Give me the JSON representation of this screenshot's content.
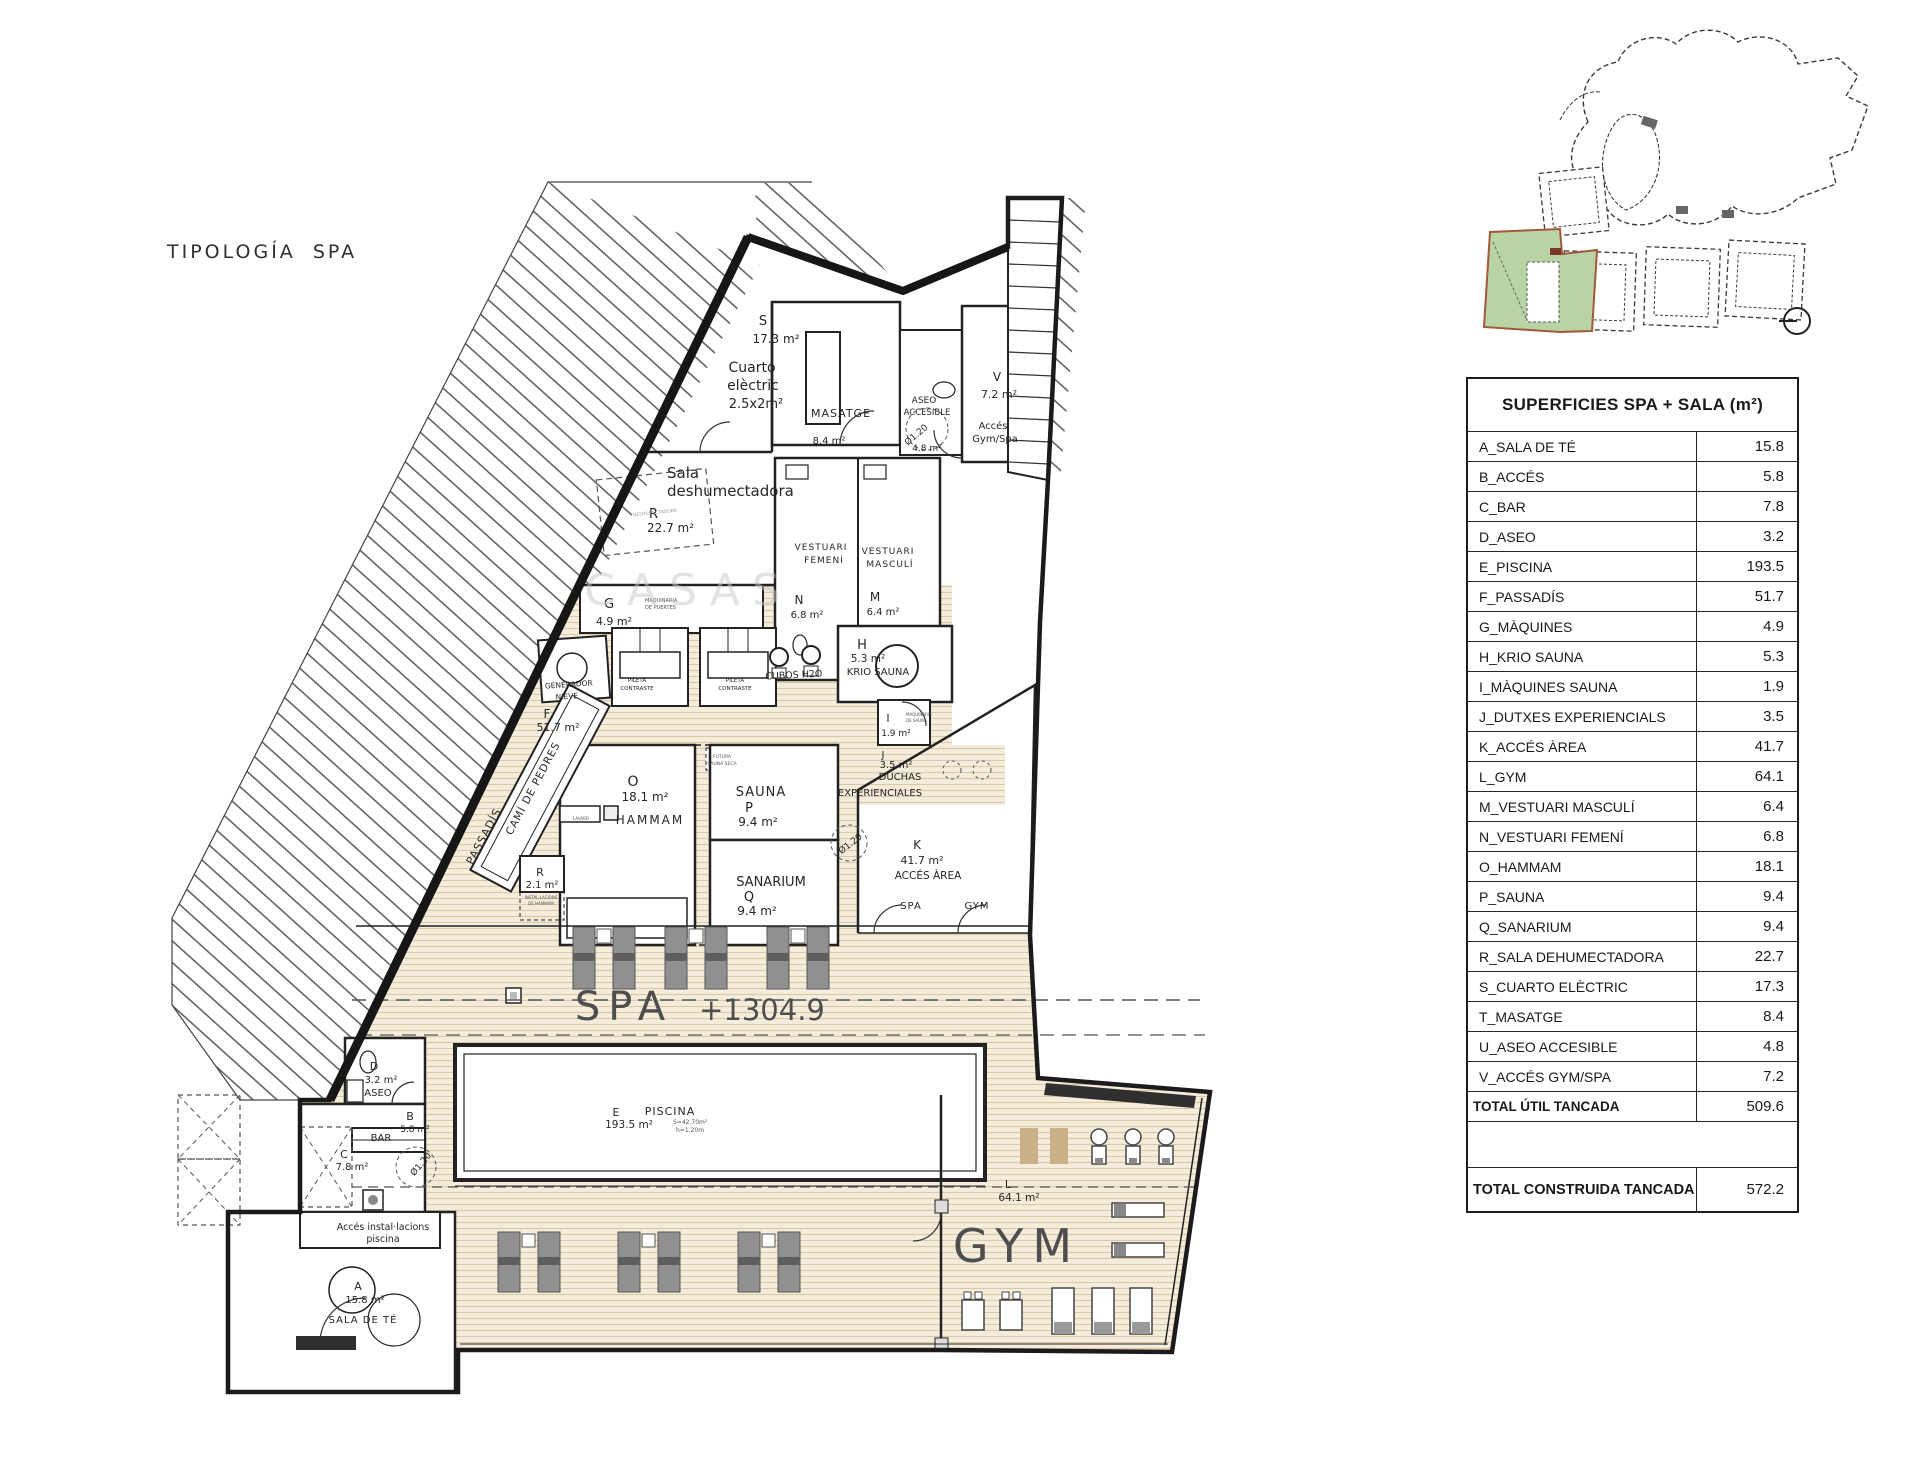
{
  "page": {
    "title": "TIPOLOGÍA SPA"
  },
  "surfaces_table": {
    "title": "SUPERFICIES SPA + SALA (m²)",
    "rows": [
      {
        "label": "A_SALA DE TÉ",
        "value": "15.8"
      },
      {
        "label": "B_ACCÉS",
        "value": "5.8"
      },
      {
        "label": "C_BAR",
        "value": "7.8"
      },
      {
        "label": "D_ASEO",
        "value": "3.2"
      },
      {
        "label": "E_PISCINA",
        "value": "193.5"
      },
      {
        "label": "F_PASSADÍS",
        "value": "51.7"
      },
      {
        "label": "G_MÀQUINES",
        "value": "4.9"
      },
      {
        "label": "H_KRIO SAUNA",
        "value": "5.3"
      },
      {
        "label": "I_MÀQUINES SAUNA",
        "value": "1.9"
      },
      {
        "label": "J_DUTXES EXPERIENCIALS",
        "value": "3.5"
      },
      {
        "label": "K_ACCÉS ÀREA",
        "value": "41.7"
      },
      {
        "label": "L_GYM",
        "value": "64.1"
      },
      {
        "label": "M_VESTUARI MASCULÍ",
        "value": "6.4"
      },
      {
        "label": "N_VESTUARI FEMENÍ",
        "value": "6.8"
      },
      {
        "label": "O_HAMMAM",
        "value": "18.1"
      },
      {
        "label": "P_SAUNA",
        "value": "9.4"
      },
      {
        "label": "Q_SANARIUM",
        "value": "9.4"
      },
      {
        "label": "R_SALA DEHUMECTADORA",
        "value": "22.7"
      },
      {
        "label": "S_CUARTO ELÈCTRIC",
        "value": "17.3"
      },
      {
        "label": "T_MASATGE",
        "value": "8.4"
      },
      {
        "label": "U_ASEO ACCESIBLE",
        "value": "4.8"
      },
      {
        "label": "V_ACCÉS GYM/SPA",
        "value": "7.2"
      }
    ],
    "total_util": {
      "label": "TOTAL ÚTIL TANCADA",
      "value": "509.6"
    },
    "total_built": {
      "label": "TOTAL CONSTRUIDA TANCADA",
      "value": "572.2"
    }
  },
  "keyplan": {
    "highlight_color": "#b9d4a4",
    "outline_color": "#a3583b"
  },
  "icons": {
    "north": "circle-with-line"
  },
  "plan": {
    "zone_labels": {
      "spa": "SPA",
      "level": "+1304.9",
      "gym": "GYM"
    },
    "labels": [
      {
        "x": 763,
        "y": 325,
        "t": "S",
        "s": 13
      },
      {
        "x": 776,
        "y": 343,
        "t": "17.3 m²",
        "s": 12
      },
      {
        "x": 752,
        "y": 372,
        "t": "Cuarto",
        "s": 14
      },
      {
        "x": 753,
        "y": 390,
        "t": "elèctric",
        "s": 14
      },
      {
        "x": 756,
        "y": 408,
        "t": "2.5x2m²",
        "s": 13
      },
      {
        "x": 841,
        "y": 417,
        "t": "MASATGE",
        "s": 11,
        "ls": 1
      },
      {
        "x": 829,
        "y": 444,
        "t": "8.4 m²",
        "s": 10
      },
      {
        "x": 924,
        "y": 403,
        "t": "ASEO",
        "s": 9
      },
      {
        "x": 927,
        "y": 415,
        "t": "ACCESIBLE",
        "s": 8.5
      },
      {
        "x": 918,
        "y": 437,
        "t": "Ø1.20",
        "s": 9,
        "r": -40
      },
      {
        "x": 927,
        "y": 451,
        "t": "4.8 m²",
        "s": 9
      },
      {
        "x": 997,
        "y": 381,
        "t": "V",
        "s": 12
      },
      {
        "x": 999,
        "y": 398,
        "t": "7.2 m²",
        "s": 11
      },
      {
        "x": 993,
        "y": 429,
        "t": "Accés",
        "s": 10
      },
      {
        "x": 995,
        "y": 442,
        "t": "Gym/Spa",
        "s": 10
      },
      {
        "x": 667,
        "y": 478,
        "t": "Sala",
        "s": 15,
        "a": "start"
      },
      {
        "x": 667,
        "y": 496,
        "t": "deshumectadora",
        "s": 15,
        "a": "start"
      },
      {
        "x": 649,
        "y": 518,
        "t": "R",
        "s": 13,
        "a": "start"
      },
      {
        "x": 647,
        "y": 532,
        "t": "22.7 m²",
        "s": 12,
        "a": "start"
      },
      {
        "x": 655,
        "y": 514,
        "t": "DESHUMECTADORA",
        "s": 4.5,
        "c": "#999",
        "r": -6,
        "n": "equip-label"
      },
      {
        "x": 609,
        "y": 608,
        "t": "G",
        "s": 13
      },
      {
        "x": 614,
        "y": 625,
        "t": "4.9 m²",
        "s": 11
      },
      {
        "x": 645,
        "y": 602,
        "t": "MAQUINARIA",
        "s": 5,
        "a": "start",
        "c": "#555"
      },
      {
        "x": 645,
        "y": 609,
        "t": "DE PUERTES",
        "s": 5,
        "a": "start",
        "c": "#555"
      },
      {
        "x": 821,
        "y": 550,
        "t": "VESTUARI",
        "s": 9,
        "ls": 1
      },
      {
        "x": 824,
        "y": 563,
        "t": "FEMENÍ",
        "s": 9,
        "ls": 1
      },
      {
        "x": 799,
        "y": 604,
        "t": "N",
        "s": 12
      },
      {
        "x": 807,
        "y": 618,
        "t": "6.8 m²",
        "s": 10
      },
      {
        "x": 888,
        "y": 554,
        "t": "VESTUARI",
        "s": 9,
        "ls": 1
      },
      {
        "x": 890,
        "y": 567,
        "t": "MASCULÍ",
        "s": 9,
        "ls": 1
      },
      {
        "x": 875,
        "y": 601,
        "t": "M",
        "s": 12
      },
      {
        "x": 883,
        "y": 615,
        "t": "6.4 m²",
        "s": 10
      },
      {
        "x": 569,
        "y": 687,
        "t": "GENERADOR",
        "s": 7.5,
        "r": -4
      },
      {
        "x": 567,
        "y": 699,
        "t": "NIEVE",
        "s": 7.5,
        "r": -4
      },
      {
        "x": 637,
        "y": 682,
        "t": "PILETA",
        "s": 5.5
      },
      {
        "x": 637,
        "y": 690,
        "t": "CONTRASTE",
        "s": 5.5
      },
      {
        "x": 735,
        "y": 682,
        "t": "PILETA",
        "s": 5.5
      },
      {
        "x": 735,
        "y": 690,
        "t": "CONTRASTE",
        "s": 5.5
      },
      {
        "x": 794,
        "y": 678,
        "t": "CUBOS H2O",
        "s": 9.5,
        "r": -3
      },
      {
        "x": 862,
        "y": 649,
        "t": "H",
        "s": 13
      },
      {
        "x": 868,
        "y": 662,
        "t": "5.3 m²",
        "s": 10.5
      },
      {
        "x": 878,
        "y": 675,
        "t": "KRIO SAUNA",
        "s": 10
      },
      {
        "x": 888,
        "y": 722,
        "t": "I",
        "s": 11
      },
      {
        "x": 906,
        "y": 716,
        "t": "MAQUINÀRIA",
        "s": 4,
        "a": "start",
        "c": "#555"
      },
      {
        "x": 906,
        "y": 722,
        "t": "DE SAUNA",
        "s": 4,
        "a": "start",
        "c": "#555"
      },
      {
        "x": 896,
        "y": 736,
        "t": "1.9 m²",
        "s": 9
      },
      {
        "x": 883,
        "y": 758,
        "t": "J",
        "s": 10
      },
      {
        "x": 896,
        "y": 768,
        "t": "3.5 m²",
        "s": 10
      },
      {
        "x": 900,
        "y": 780,
        "t": "DUCHAS",
        "s": 10
      },
      {
        "x": 880,
        "y": 796,
        "t": "EXPERIENCIALES",
        "s": 10
      },
      {
        "x": 633,
        "y": 786,
        "t": "O",
        "s": 14
      },
      {
        "x": 645,
        "y": 801,
        "t": "18.1 m²",
        "s": 12
      },
      {
        "x": 650,
        "y": 824,
        "t": "HAMMAM",
        "s": 12,
        "ls": 2
      },
      {
        "x": 581,
        "y": 820,
        "t": "LAVABO",
        "s": 4,
        "c": "#555"
      },
      {
        "x": 722,
        "y": 758,
        "t": "FUTURA",
        "s": 4.5,
        "c": "#555"
      },
      {
        "x": 722,
        "y": 765,
        "t": "SAUNA SECA",
        "s": 4.5,
        "c": "#555"
      },
      {
        "x": 761,
        "y": 796,
        "t": "SAUNA",
        "s": 13,
        "ls": 1
      },
      {
        "x": 749,
        "y": 812,
        "t": "P",
        "s": 13
      },
      {
        "x": 758,
        "y": 826,
        "t": "9.4 m²",
        "s": 12
      },
      {
        "x": 771,
        "y": 886,
        "t": "SANARIUM",
        "s": 13
      },
      {
        "x": 749,
        "y": 901,
        "t": "Q",
        "s": 13
      },
      {
        "x": 757,
        "y": 915,
        "t": "9.4 m²",
        "s": 12
      },
      {
        "x": 917,
        "y": 849,
        "t": "K",
        "s": 12
      },
      {
        "x": 922,
        "y": 864,
        "t": "41.7 m²",
        "s": 11
      },
      {
        "x": 928,
        "y": 879,
        "t": "ACCÉS ÀREA",
        "s": 10.5
      },
      {
        "x": 852,
        "y": 846,
        "t": "Ø1.20",
        "s": 9,
        "r": -38
      },
      {
        "x": 911,
        "y": 909,
        "t": "SPA",
        "s": 10,
        "ls": 1
      },
      {
        "x": 977,
        "y": 909,
        "t": "GYM",
        "s": 10,
        "ls": 1
      },
      {
        "x": 547,
        "y": 718,
        "t": "F",
        "s": 12
      },
      {
        "x": 558,
        "y": 731,
        "t": "51.7 m²",
        "s": 11
      },
      {
        "x": 487,
        "y": 838,
        "t": "PASSADÍS",
        "s": 11,
        "r": -62,
        "ls": 1
      },
      {
        "x": 536,
        "y": 790,
        "t": "CAMÍ DE PEDRES",
        "s": 10.5,
        "r": -62,
        "ls": 1
      },
      {
        "x": 540,
        "y": 876,
        "t": "R",
        "s": 11
      },
      {
        "x": 542,
        "y": 888,
        "t": "2.1 m²",
        "s": 10
      },
      {
        "x": 541,
        "y": 899,
        "t": "INSTAL·LACIONS",
        "s": 4,
        "c": "#555"
      },
      {
        "x": 541,
        "y": 905,
        "t": "DE HAMMAM",
        "s": 4,
        "c": "#555"
      },
      {
        "x": 624,
        "y": 1020,
        "t": "SPA",
        "s": 40,
        "ls": 8,
        "c": "#4e4e4e",
        "n": "zone-label-spa"
      },
      {
        "x": 762,
        "y": 1020,
        "t": "+1304.9",
        "s": 29,
        "c": "#4e4e4e",
        "n": "level-label"
      },
      {
        "x": 1017,
        "y": 1262,
        "t": "GYM",
        "s": 46,
        "ls": 9,
        "c": "#4e4e4e",
        "n": "zone-label-gym"
      },
      {
        "x": 1008,
        "y": 1188,
        "t": "L",
        "s": 11
      },
      {
        "x": 1019,
        "y": 1201,
        "t": "64.1 m²",
        "s": 10.5
      },
      {
        "x": 616,
        "y": 1116,
        "t": "E",
        "s": 11
      },
      {
        "x": 670,
        "y": 1115,
        "t": "PISCINA",
        "s": 11,
        "ls": 1
      },
      {
        "x": 629,
        "y": 1128,
        "t": "193.5 m²",
        "s": 10.5
      },
      {
        "x": 673,
        "y": 1124,
        "t": "S=42.70m²",
        "s": 6,
        "a": "start",
        "c": "#555"
      },
      {
        "x": 676,
        "y": 1132,
        "t": "h=1.20m",
        "s": 6,
        "a": "start",
        "c": "#555"
      },
      {
        "x": 374,
        "y": 1070,
        "t": "D",
        "s": 11
      },
      {
        "x": 381,
        "y": 1083,
        "t": "3.2 m²",
        "s": 10
      },
      {
        "x": 378,
        "y": 1096,
        "t": "ASEO",
        "s": 10
      },
      {
        "x": 410,
        "y": 1120,
        "t": "B",
        "s": 11
      },
      {
        "x": 415,
        "y": 1132,
        "t": "5.8 m²",
        "s": 9
      },
      {
        "x": 381,
        "y": 1141,
        "t": "BAR",
        "s": 10
      },
      {
        "x": 344,
        "y": 1158,
        "t": "C",
        "s": 11
      },
      {
        "x": 352,
        "y": 1170,
        "t": "7.8 m²",
        "s": 10
      },
      {
        "x": 423,
        "y": 1166,
        "t": "Ø1.20",
        "s": 9,
        "r": -50
      },
      {
        "x": 383,
        "y": 1230,
        "t": "Accés instal·lacions",
        "s": 9.5
      },
      {
        "x": 383,
        "y": 1242,
        "t": "piscina",
        "s": 9.5
      },
      {
        "x": 358,
        "y": 1290,
        "t": "A",
        "s": 11
      },
      {
        "x": 365,
        "y": 1303,
        "t": "15.8 m²",
        "s": 10
      },
      {
        "x": 363,
        "y": 1323,
        "t": "SALA DE TÉ",
        "s": 10,
        "ls": 1
      },
      {
        "x": 688,
        "y": 605,
        "t": "CASAS",
        "s": 44,
        "ls": 12,
        "c": "#c9c9c9",
        "o": 0.5,
        "n": "watermark"
      }
    ]
  }
}
